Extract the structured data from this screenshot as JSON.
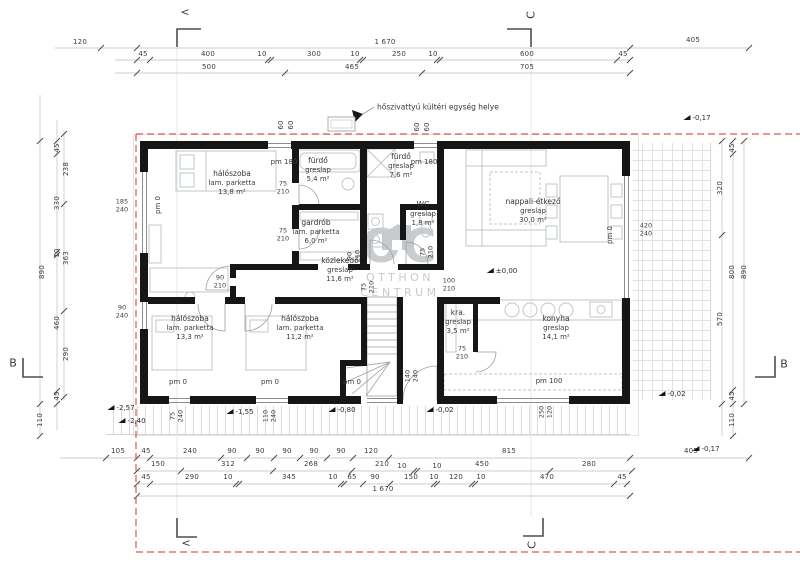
{
  "colors": {
    "wall": "#161616",
    "boundary_red": "#e0564f",
    "dim_line": "#b9b9b9",
    "dim_text": "#3b3b3b",
    "furniture": "#c2c7ca",
    "watermark": "#c9cdd0"
  },
  "note": {
    "text": "hőszivattyú kültéri egység helye"
  },
  "watermark": {
    "brand": "OC",
    "line1": "OTTHON",
    "line2": "CENTRUM"
  },
  "level_reference": "±0,00",
  "rooms": [
    {
      "name": "hálószoba",
      "floor": "lam. parketta",
      "area": "13,8 m²",
      "x": 232,
      "y": 183
    },
    {
      "name": "fürdő",
      "floor": "greslap",
      "area": "5,4 m²",
      "x": 318,
      "y": 170
    },
    {
      "name": "fürdő",
      "floor": "greslap",
      "area": "7,6 m²",
      "x": 401,
      "y": 166
    },
    {
      "name": "gardrób",
      "floor": "lam. parketta",
      "area": "6,0 m²",
      "x": 316,
      "y": 232
    },
    {
      "name": "WC",
      "floor": "greslap",
      "area": "1,8 m²",
      "x": 423,
      "y": 214
    },
    {
      "name": "közlekedő",
      "floor": "greslap",
      "area": "11,6 m²",
      "x": 340,
      "y": 270
    },
    {
      "name": "nappali-étkező",
      "floor": "greslap",
      "area": "30,0 m²",
      "x": 533,
      "y": 211
    },
    {
      "name": "hálószoba",
      "floor": "lam. parketta",
      "area": "13,3 m²",
      "x": 190,
      "y": 328
    },
    {
      "name": "hálószoba",
      "floor": "lam. parketta",
      "area": "11,2 m²",
      "x": 300,
      "y": 328
    },
    {
      "name": "kra.",
      "floor": "greslap",
      "area": "3,5 m²",
      "x": 458,
      "y": 322
    },
    {
      "name": "konyha",
      "floor": "greslap",
      "area": "14,1 m²",
      "x": 556,
      "y": 328
    }
  ],
  "pm_labels": [
    {
      "t": "pm 0",
      "x": 158,
      "y": 205,
      "r": 1
    },
    {
      "t": "pm 180",
      "x": 284,
      "y": 162,
      "r": 0
    },
    {
      "t": "pm 180",
      "x": 424,
      "y": 162,
      "r": 0
    },
    {
      "t": "pm 0",
      "x": 610,
      "y": 235,
      "r": 1
    },
    {
      "t": "pm 0",
      "x": 178,
      "y": 382,
      "r": 0
    },
    {
      "t": "pm 0",
      "x": 270,
      "y": 382,
      "r": 0
    },
    {
      "t": "pm 0",
      "x": 352,
      "y": 382,
      "r": 0
    },
    {
      "t": "pm 100",
      "x": 549,
      "y": 381,
      "r": 0
    }
  ],
  "levels": [
    {
      "t": "±0,00",
      "x": 502,
      "y": 271
    },
    {
      "t": "-0,17",
      "x": 697,
      "y": 118
    },
    {
      "t": "-0,02",
      "x": 672,
      "y": 394
    },
    {
      "t": "-2,57",
      "x": 121,
      "y": 408
    },
    {
      "t": "-2,40",
      "x": 132,
      "y": 421
    },
    {
      "t": "-1,55",
      "x": 240,
      "y": 412
    },
    {
      "t": "-0,80",
      "x": 342,
      "y": 410
    },
    {
      "t": "-0,02",
      "x": 440,
      "y": 410
    },
    {
      "t": "-0,17",
      "x": 706,
      "y": 449
    }
  ],
  "section_markers": [
    {
      "t": "<",
      "x": 185,
      "y": 12,
      "r": 0
    },
    {
      "t": "C",
      "x": 531,
      "y": 15,
      "r": 1
    },
    {
      "t": "B",
      "x": 13,
      "y": 363,
      "r": 0
    },
    {
      "t": "B",
      "x": 784,
      "y": 364,
      "r": 0
    },
    {
      "t": "<",
      "x": 186,
      "y": 543,
      "r": 0
    },
    {
      "t": "C",
      "x": 532,
      "y": 545,
      "r": 1
    }
  ],
  "openings": [
    {
      "w": "75",
      "h": "210",
      "x": 283,
      "y": 188,
      "r": 0
    },
    {
      "w": "75",
      "h": "210",
      "x": 283,
      "y": 235,
      "r": 0
    },
    {
      "w": "90",
      "h": "210",
      "x": 220,
      "y": 282,
      "r": 0
    },
    {
      "w": "100",
      "h": "210",
      "x": 449,
      "y": 285,
      "r": 0
    },
    {
      "w": "75",
      "h": "210",
      "x": 462,
      "y": 353,
      "r": 0
    },
    {
      "w": "185",
      "h": "240",
      "x": 122,
      "y": 206,
      "r": 0
    },
    {
      "w": "90",
      "h": "240",
      "x": 122,
      "y": 312,
      "r": 0
    },
    {
      "w": "420",
      "h": "240",
      "x": 646,
      "y": 230,
      "r": 0
    },
    {
      "w": "90",
      "h": "210",
      "x": 354,
      "y": 256,
      "r": 1
    },
    {
      "w": "75",
      "h": "210",
      "x": 427,
      "y": 252,
      "r": 1
    },
    {
      "w": "75",
      "h": "210",
      "x": 368,
      "y": 287,
      "r": 1
    },
    {
      "w": "140",
      "h": "240",
      "x": 412,
      "y": 376,
      "r": 1
    },
    {
      "w": "250",
      "h": "120",
      "x": 546,
      "y": 412,
      "r": 1
    },
    {
      "w": "75",
      "h": "240",
      "x": 177,
      "y": 416,
      "r": 1
    },
    {
      "w": "110",
      "h": "240",
      "x": 270,
      "y": 416,
      "r": 1
    }
  ],
  "dims": [
    {
      "t": "120",
      "x": 80,
      "y": 42,
      "r": 0
    },
    {
      "t": "1 670",
      "x": 385,
      "y": 42,
      "r": 0
    },
    {
      "t": "405",
      "x": 693,
      "y": 40,
      "r": 0
    },
    {
      "t": "45",
      "x": 143,
      "y": 54,
      "r": 0
    },
    {
      "t": "400",
      "x": 208,
      "y": 54,
      "r": 0
    },
    {
      "t": "10",
      "x": 262,
      "y": 54,
      "r": 0
    },
    {
      "t": "300",
      "x": 314,
      "y": 54,
      "r": 0
    },
    {
      "t": "10",
      "x": 355,
      "y": 54,
      "r": 0
    },
    {
      "t": "250",
      "x": 399,
      "y": 54,
      "r": 0
    },
    {
      "t": "10",
      "x": 433,
      "y": 54,
      "r": 0
    },
    {
      "t": "600",
      "x": 527,
      "y": 54,
      "r": 0
    },
    {
      "t": "45",
      "x": 623,
      "y": 54,
      "r": 0
    },
    {
      "t": "500",
      "x": 209,
      "y": 67,
      "r": 0
    },
    {
      "t": "465",
      "x": 352,
      "y": 67,
      "r": 0
    },
    {
      "t": "705",
      "x": 527,
      "y": 67,
      "r": 0
    },
    {
      "t": "60",
      "x": 281,
      "y": 125,
      "r": 1
    },
    {
      "t": "60",
      "x": 291,
      "y": 125,
      "r": 1
    },
    {
      "t": "60",
      "x": 417,
      "y": 127,
      "r": 1
    },
    {
      "t": "60",
      "x": 427,
      "y": 127,
      "r": 1
    },
    {
      "t": "45",
      "x": 57,
      "y": 148,
      "r": 1
    },
    {
      "t": "330",
      "x": 57,
      "y": 203,
      "r": 1
    },
    {
      "t": "10",
      "x": 57,
      "y": 253,
      "r": 1
    },
    {
      "t": "460",
      "x": 57,
      "y": 323,
      "r": 1
    },
    {
      "t": "45",
      "x": 57,
      "y": 396,
      "r": 1
    },
    {
      "t": "238",
      "x": 66,
      "y": 169,
      "r": 1
    },
    {
      "t": "363",
      "x": 66,
      "y": 258,
      "r": 1
    },
    {
      "t": "290",
      "x": 66,
      "y": 354,
      "r": 1
    },
    {
      "t": "890",
      "x": 42,
      "y": 272,
      "r": 1
    },
    {
      "t": "110",
      "x": 40,
      "y": 420,
      "r": 1
    },
    {
      "t": "320",
      "x": 720,
      "y": 188,
      "r": 1
    },
    {
      "t": "570",
      "x": 720,
      "y": 319,
      "r": 1
    },
    {
      "t": "45",
      "x": 732,
      "y": 148,
      "r": 1
    },
    {
      "t": "800",
      "x": 732,
      "y": 272,
      "r": 1
    },
    {
      "t": "45",
      "x": 732,
      "y": 396,
      "r": 1
    },
    {
      "t": "110",
      "x": 732,
      "y": 420,
      "r": 1
    },
    {
      "t": "890",
      "x": 744,
      "y": 272,
      "r": 1
    },
    {
      "t": "105",
      "x": 118,
      "y": 451,
      "r": 0
    },
    {
      "t": "45",
      "x": 146,
      "y": 451,
      "r": 0
    },
    {
      "t": "240",
      "x": 190,
      "y": 451,
      "r": 0
    },
    {
      "t": "90",
      "x": 232,
      "y": 451,
      "r": 0
    },
    {
      "t": "90",
      "x": 260,
      "y": 451,
      "r": 0
    },
    {
      "t": "90",
      "x": 287,
      "y": 451,
      "r": 0
    },
    {
      "t": "90",
      "x": 314,
      "y": 451,
      "r": 0
    },
    {
      "t": "90",
      "x": 341,
      "y": 451,
      "r": 0
    },
    {
      "t": "120",
      "x": 371,
      "y": 451,
      "r": 0
    },
    {
      "t": "815",
      "x": 509,
      "y": 451,
      "r": 0
    },
    {
      "t": "405",
      "x": 691,
      "y": 451,
      "r": 0
    },
    {
      "t": "150",
      "x": 158,
      "y": 464,
      "r": 0
    },
    {
      "t": "312",
      "x": 228,
      "y": 464,
      "r": 0
    },
    {
      "t": "268",
      "x": 311,
      "y": 464,
      "r": 0
    },
    {
      "t": "210",
      "x": 382,
      "y": 464,
      "r": 0
    },
    {
      "t": "10",
      "x": 402,
      "y": 466,
      "r": 0
    },
    {
      "t": "10",
      "x": 437,
      "y": 466,
      "r": 0
    },
    {
      "t": "450",
      "x": 482,
      "y": 464,
      "r": 0
    },
    {
      "t": "280",
      "x": 589,
      "y": 464,
      "r": 0
    },
    {
      "t": "45",
      "x": 146,
      "y": 477,
      "r": 0
    },
    {
      "t": "290",
      "x": 192,
      "y": 477,
      "r": 0
    },
    {
      "t": "10",
      "x": 228,
      "y": 477,
      "r": 0
    },
    {
      "t": "345",
      "x": 289,
      "y": 477,
      "r": 0
    },
    {
      "t": "10",
      "x": 333,
      "y": 477,
      "r": 0
    },
    {
      "t": "65",
      "x": 352,
      "y": 477,
      "r": 0
    },
    {
      "t": "90",
      "x": 375,
      "y": 477,
      "r": 0
    },
    {
      "t": "150",
      "x": 411,
      "y": 477,
      "r": 0
    },
    {
      "t": "10",
      "x": 434,
      "y": 477,
      "r": 0
    },
    {
      "t": "120",
      "x": 456,
      "y": 477,
      "r": 0
    },
    {
      "t": "10",
      "x": 481,
      "y": 477,
      "r": 0
    },
    {
      "t": "470",
      "x": 547,
      "y": 477,
      "r": 0
    },
    {
      "t": "45",
      "x": 622,
      "y": 477,
      "r": 0
    },
    {
      "t": "1 670",
      "x": 383,
      "y": 489,
      "r": 0
    }
  ]
}
